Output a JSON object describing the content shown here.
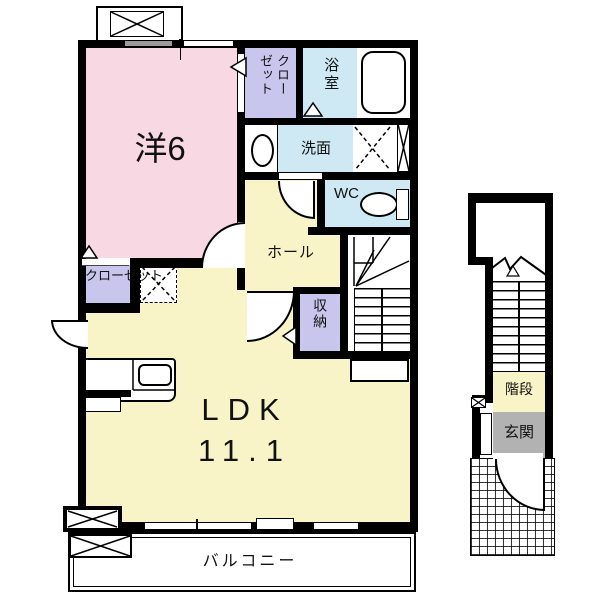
{
  "colors": {
    "wall": "#000000",
    "pink": "#f8d8e2",
    "purple": "#c8c6ec",
    "blue": "#cfe9f4",
    "yellow": "#f9f3c8",
    "gray": "#b2b2b2",
    "bg": "#ffffff"
  },
  "rooms": {
    "western": {
      "label": "洋6"
    },
    "closet1": {
      "label": "クローゼット"
    },
    "bath": {
      "label": "浴室"
    },
    "wash": {
      "label": "洗面"
    },
    "wc": {
      "label": "WC"
    },
    "hall": {
      "label": "ホール"
    },
    "closet2": {
      "label": "クローゼット"
    },
    "storage": {
      "label": "収納"
    },
    "ldk": {
      "label": "LDK",
      "area": "11.1"
    },
    "balcony": {
      "label": "バルコニー"
    },
    "stairs": {
      "label": "階段"
    },
    "entrance": {
      "label": "玄関"
    }
  }
}
